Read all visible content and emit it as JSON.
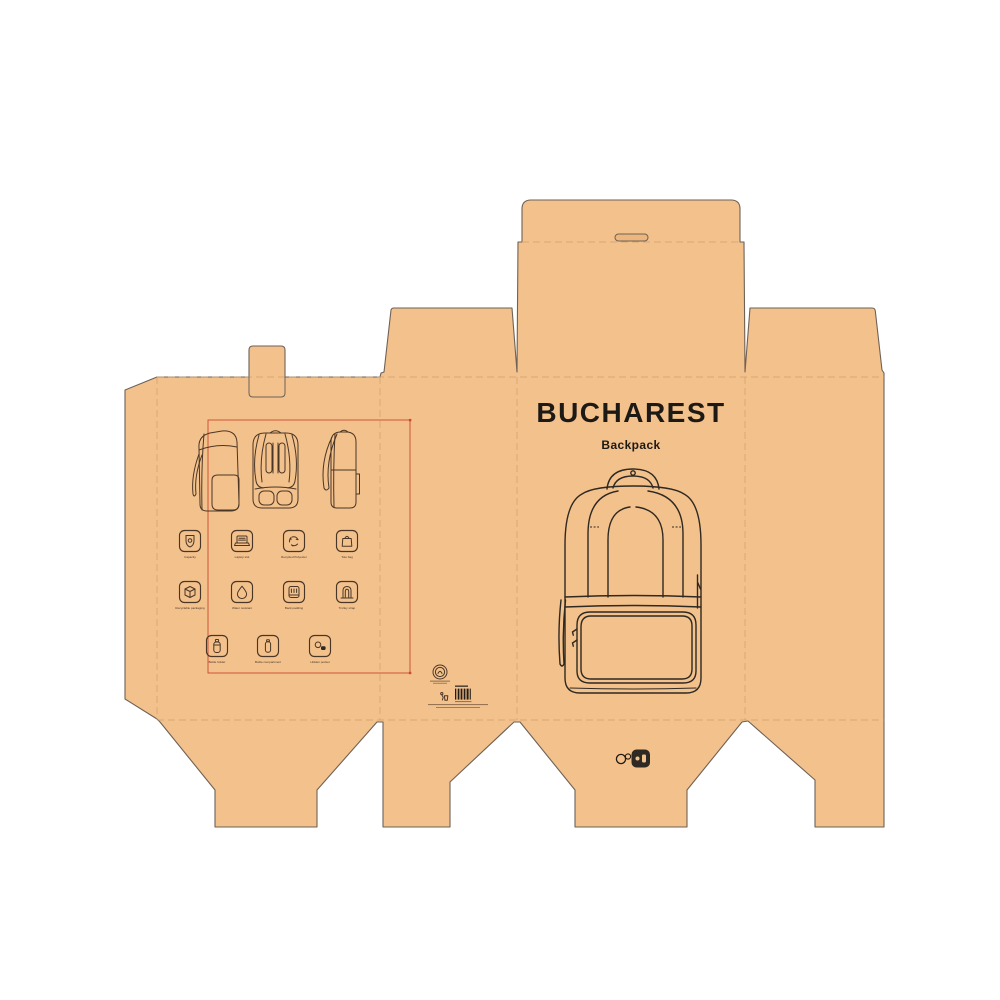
{
  "front_panel": {
    "title": "BUCHAREST",
    "subtitle": "Backpack"
  },
  "back_panel": {
    "product_views": [
      "three-quarter-front-view",
      "back-view",
      "side-view"
    ],
    "features": [
      {
        "icon": "shield-icon",
        "label": "Capacity"
      },
      {
        "icon": "laptop-icon",
        "label": "Laptop slot"
      },
      {
        "icon": "recycle-icon",
        "label": "Recycled Polyester"
      },
      {
        "icon": "tote-bag-icon",
        "label": "Tote bag"
      },
      {
        "icon": "package-box-icon",
        "label": "Recyclable packaging"
      },
      {
        "icon": "water-drop-icon",
        "label": "Water resistant"
      },
      {
        "icon": "back-padding-icon",
        "label": "Back padding"
      },
      {
        "icon": "trolley-strap-icon",
        "label": "Trolley strap"
      },
      {
        "icon": "bottle-holder-icon",
        "label": "Bottle holder"
      },
      {
        "icon": "bottle-compartment-icon",
        "label": "Bottle compartment"
      },
      {
        "icon": "hidden-pocket-icon",
        "label": "Hidden pocket"
      }
    ]
  },
  "side_panel": {
    "marks": [
      "certification-mark",
      "tidyman-icon",
      "barcode"
    ]
  },
  "bottom_flap": {
    "marks": [
      "brand-logo"
    ]
  },
  "colors": {
    "kraft": "#f3c18c",
    "outline": "#6e6156",
    "fold": "#cf9f68",
    "ink": "#4a3626",
    "ink_dark": "#2e2922",
    "title": "#1d1a16",
    "accent": "#cc4a2e",
    "background": "#ffffff"
  }
}
